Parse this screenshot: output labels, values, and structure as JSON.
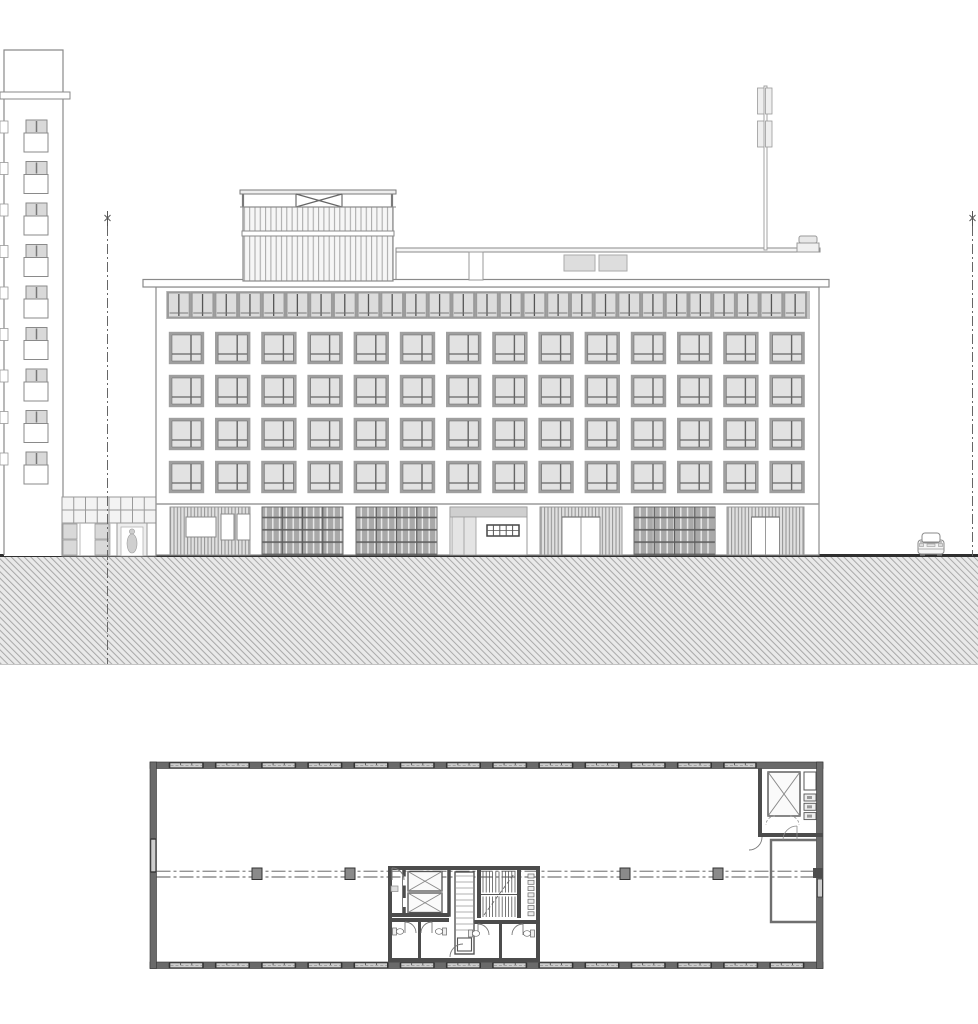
{
  "meta": {
    "title": "Architectural drawing: street elevation of a five-storey office building above a hatched ground section, with a long rectangular upper-floor plan below",
    "canvas": {
      "width": 978,
      "height": 1024
    }
  },
  "palette": {
    "line": "#8a8a8a",
    "line_mid": "#6f6f6f",
    "line_dark": "#555555",
    "line_black": "#2f2f2f",
    "glass": "#e2e2e2",
    "panel": "#dcdcdc",
    "attic_bg": "#c4c4c4",
    "grille": "#a9a9a9",
    "grille_dark": "#5f5f5f",
    "wall_plan": "#4c4c4c",
    "wall_outer": "#6a6a6a",
    "plan_window": "#cdcdcd",
    "hatch_bg": "#e9e9e9",
    "hatch_line": "#a8a8a8",
    "column_fill": "#8a8a8a",
    "white": "#ffffff"
  },
  "elevation": {
    "neighbor_tower": {
      "window_units": 9,
      "unit_pitch": 41.5,
      "first_unit_y": 120
    },
    "facade": {
      "window_rows": 4,
      "windows_per_row": 14,
      "row_y": [
        333,
        376,
        419,
        462
      ],
      "window_w": 33,
      "window_h": 30,
      "first_x": 170,
      "pitch": 46.2,
      "attic_panels": 27,
      "ground_bays": [
        {
          "type": "louver-display",
          "x": 170,
          "w": 80
        },
        {
          "type": "grid",
          "x": 262,
          "w": 81
        },
        {
          "type": "grid",
          "x": 356,
          "w": 81
        },
        {
          "type": "storefront",
          "x": 450,
          "w": 77
        },
        {
          "type": "louver-door",
          "x": 540,
          "w": 82,
          "door_w": 38
        },
        {
          "type": "grid",
          "x": 634,
          "w": 81
        },
        {
          "type": "louver-door",
          "x": 727,
          "w": 77,
          "door_w": 28
        }
      ]
    },
    "rooftop": {
      "penthouse": true,
      "x_brace_railing": true,
      "skylights": 2,
      "chimney": 1,
      "antenna_panel_pairs": 2
    },
    "annex": {
      "glazing_cols": 8,
      "glazing_rows": 2,
      "door_person": true
    },
    "site": {
      "property_lines": 2,
      "car": 1,
      "ground_hatch": true
    }
  },
  "floor_plan": {
    "ribbon_windows_top": 13,
    "ribbon_windows_bottom": 14,
    "left_wall_windows": 1,
    "grid_columns_x": [
      257,
      350,
      625,
      718
    ],
    "core_elevators": 2,
    "top_right_elevator": 1,
    "stair_flights": 2,
    "wc_rooms": 4,
    "service_shaft": 1
  }
}
